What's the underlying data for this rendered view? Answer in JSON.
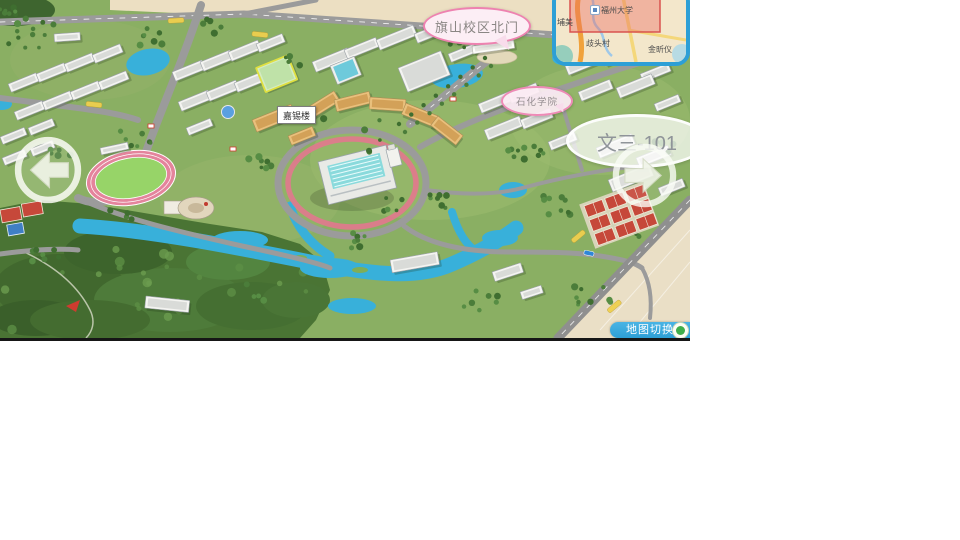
{
  "bubbles": {
    "north_gate": "旗山校区北门",
    "petro_college": "石化学院",
    "room": "文三-101",
    "building_tag": "嘉锡楼"
  },
  "minimap": {
    "university": "福州大学",
    "place_west": "埔美",
    "place_south": "歧头村",
    "place_east": "金昕仪"
  },
  "controls": {
    "map_switch": "地图切换",
    "prev_icon": "arrow-left",
    "next_icon": "arrow-right",
    "switch_icon": "globe-toggle"
  },
  "colors": {
    "accent_blue": "#2d9fd6",
    "bubble_pink_border": "#ee82b0",
    "bubble_pink_fill": "#fceef5",
    "water": "#38b0da",
    "grass": "#8aaf63",
    "road": "#9b9b9b",
    "sand": "#ecdfc2",
    "court_red": "#c6483a",
    "track_pink": "#e4849c",
    "highlight_yellow": "#e0e040",
    "viewport_red": "#d9534f"
  }
}
